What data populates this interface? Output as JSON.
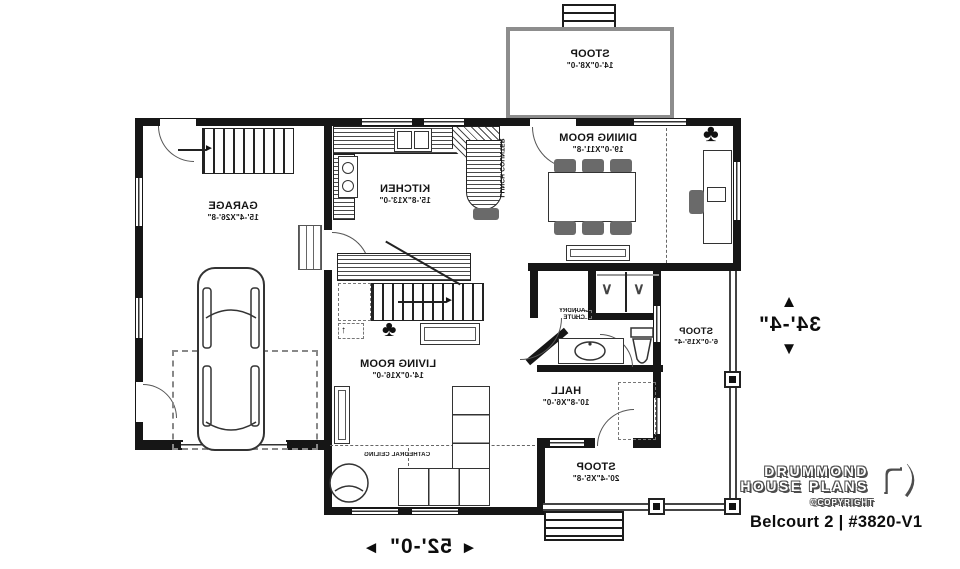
{
  "plan": {
    "rooms": {
      "stoop_top": {
        "name": "STOOP",
        "dims": "14'-0\"X8'-0\""
      },
      "dining": {
        "name": "DINING ROOM",
        "dims": "19'-0\"X11'-8\""
      },
      "kitchen": {
        "name": "KITCHEN",
        "dims": "15'-8\"X13'-0\""
      },
      "garage": {
        "name": "GARAGE",
        "dims": "15'-4\"X26'-8\""
      },
      "living": {
        "name": "LIVING ROOM",
        "dims": "14'-0\"X16'-0\""
      },
      "hall": {
        "name": "HALL",
        "dims": "10'-8\"X6'-0\""
      },
      "stoop_right": {
        "name": "STOOP",
        "dims": "6'-0\"X15'-4\""
      },
      "stoop_bottom": {
        "name": "STOOP",
        "dims": "20'-4\"X5'-8\""
      }
    },
    "annotations": {
      "lunch_counter": "LUNCH COUNTER",
      "laundry_chute_1": "LAUNDRY",
      "laundry_chute_2": "CHUTE",
      "cathedral_ceiling": "CATHEDRAL CEILING"
    },
    "dimensions": {
      "width": "52'-0\"",
      "height": "34'-4\""
    },
    "icons": {
      "arrow_up_glyph": "▲",
      "arrow_down_glyph": "▼",
      "arrow_left_glyph": "◄",
      "arrow_right_glyph": "►",
      "stair_arrow": "►",
      "up_arrow": "↑",
      "plant": "♣",
      "hanger": "∨"
    }
  },
  "branding": {
    "line1": "DRUMMOND",
    "line2": "HOUSE PLANS",
    "copyright": "©COPYRIGHT",
    "title": "Belcourt 2 | #3820-V1"
  },
  "colors": {
    "ink": "#161616",
    "accent_gray": "#8d8d8d"
  }
}
